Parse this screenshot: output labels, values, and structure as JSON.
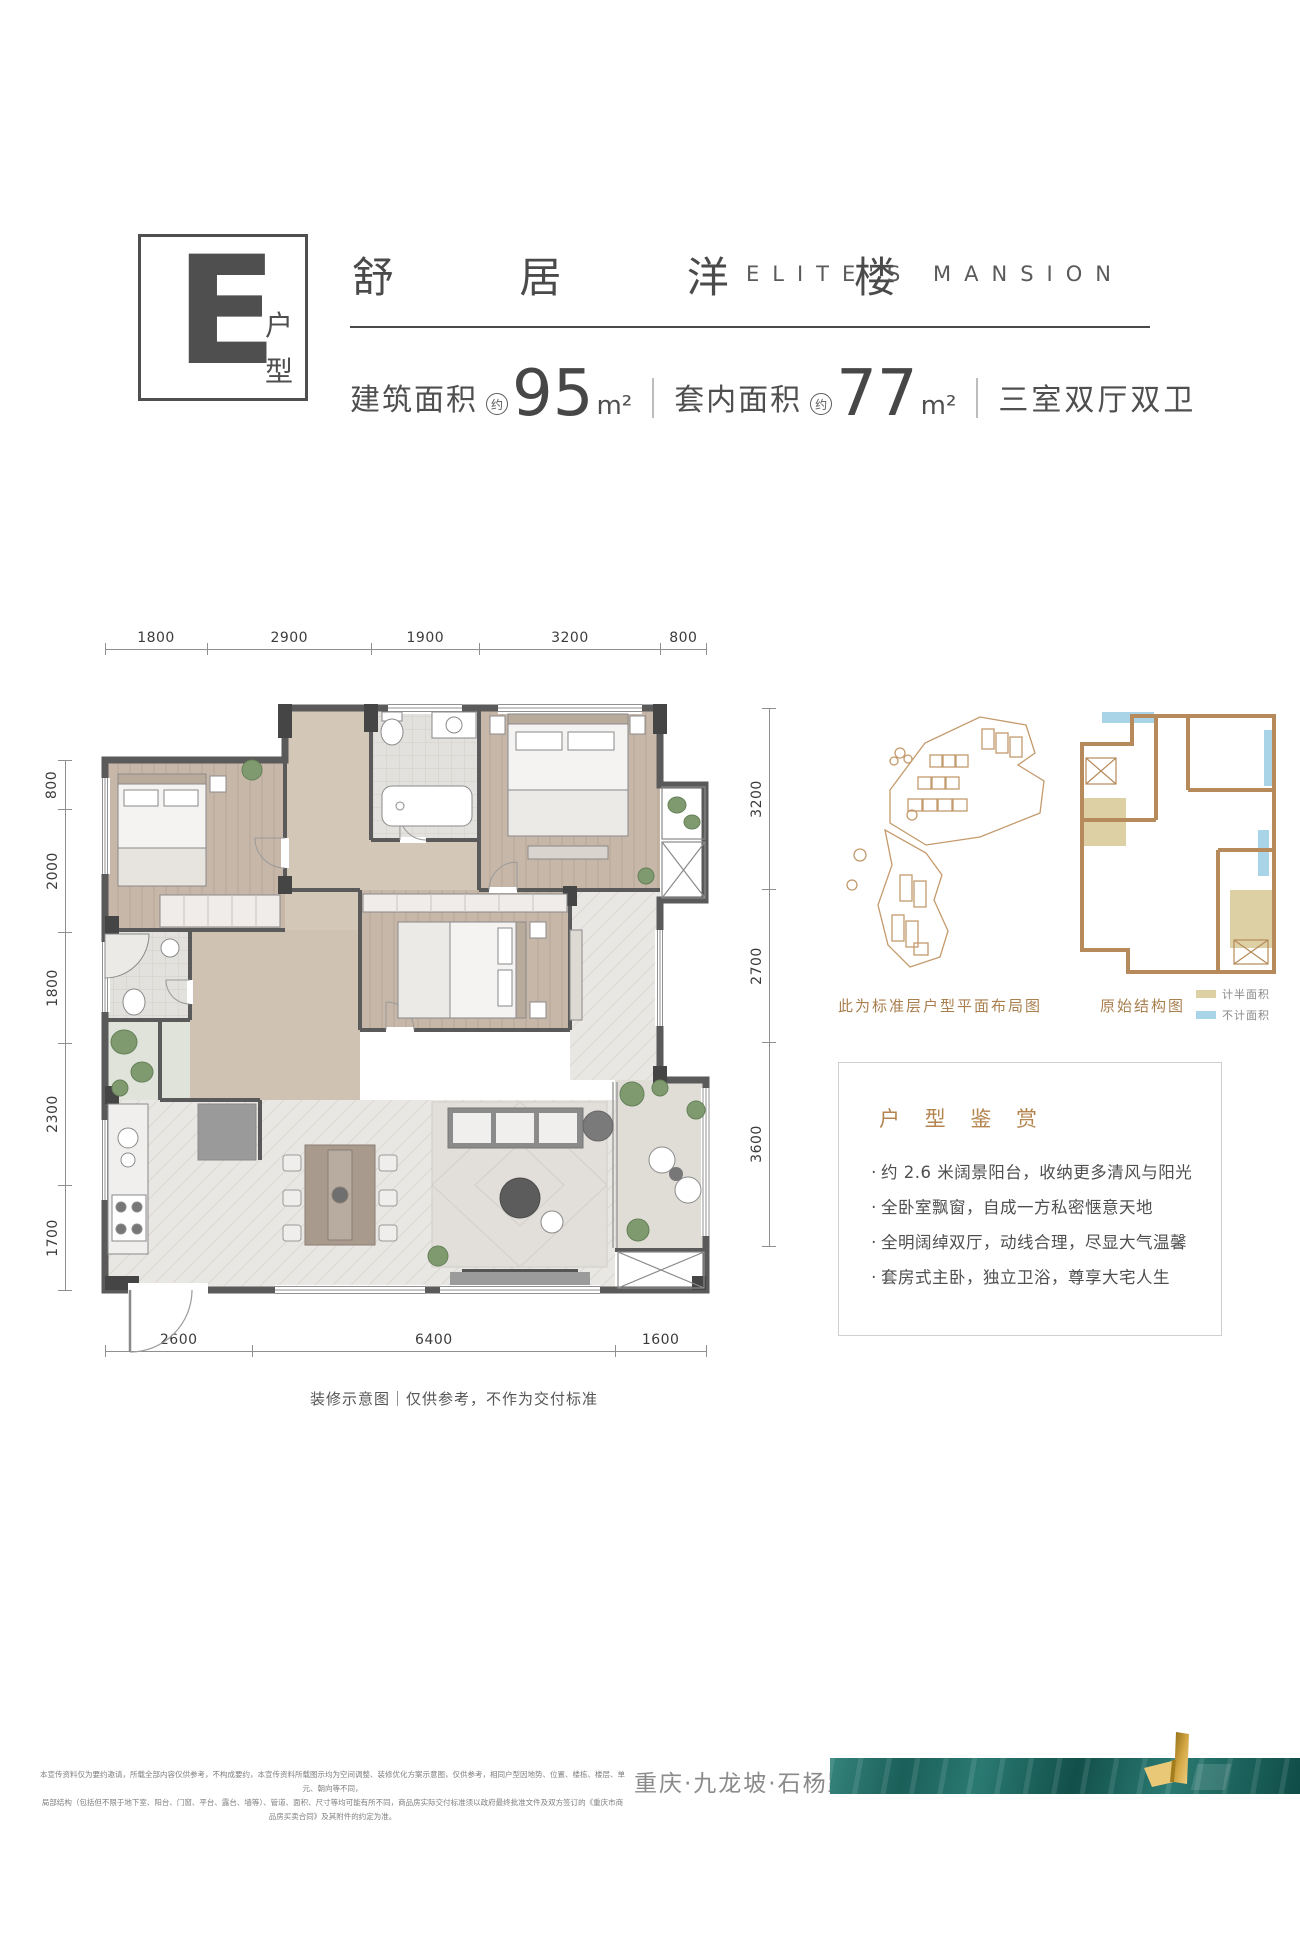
{
  "header": {
    "unit_letter": "E",
    "unit_label": "户型",
    "title_cn": "舒 居 洋 楼",
    "title_en": "ELITE'S MANSION",
    "approx": "约",
    "area_build_label": "建筑面积",
    "area_build_value": "95",
    "area_build_unit": "m²",
    "area_inner_label": "套内面积",
    "area_inner_value": "77",
    "area_inner_unit": "m²",
    "rooms_text": "三室双厅双卫"
  },
  "plan": {
    "dims_top": [
      "1800",
      "2900",
      "1900",
      "3200",
      "800"
    ],
    "dims_left": [
      "800",
      "2000",
      "1800",
      "2300",
      "1700"
    ],
    "dims_right": [
      "3200",
      "2700",
      "3600"
    ],
    "dims_bottom": [
      "2600",
      "6400",
      "1600"
    ],
    "caption": "装修示意图｜仅供参考，不作为交付标准"
  },
  "side": {
    "site_caption": "此为标准层户型平面布局图",
    "structure_caption": "原始结构图",
    "legend": [
      {
        "label": "计半面积",
        "color": "#ddd0a4"
      },
      {
        "label": "不计面积",
        "color": "#a9d3e7"
      }
    ]
  },
  "highlights": {
    "title": "户 型 鉴 赏",
    "bullet": "·",
    "items": [
      "约 2.6 米阔景阳台，收纳更多清风与阳光",
      "全卧室飘窗，自成一方私密惬意天地",
      "全明阔绰双厅，动线合理，尽显大气温馨",
      "套房式主卧，独立卫浴，尊享大宅人生"
    ]
  },
  "footer": {
    "disclaimer_line1": "本宣传资料仅为要约邀请，所载全部内容仅供参考，不构成要约，本宣传资料所载图示均为空间调整、装修优化方案示意图，仅供参考，相同户型因地势、位置、楼栋、楼层、单元、朝向等不同，",
    "disclaimer_line2": "局部结构（包括但不限于地下室、阳台、门窗、平台、露台、墙等）、管道、面积、尺寸等均可能有所不同，商品房实际交付标准须以政府最终批准文件及双方签订的《重庆市商品房买卖合同》及其附件的约定为准。",
    "location": "重庆·九龙坡·石杨路"
  },
  "colors": {
    "accent_tan": "#b5854f",
    "wall_gray": "#5a5a5a",
    "banner_teal": "#1f6b64",
    "gold": "#d4a845",
    "legend_half": "#ddd0a4",
    "legend_excluded": "#a9d3e7"
  }
}
